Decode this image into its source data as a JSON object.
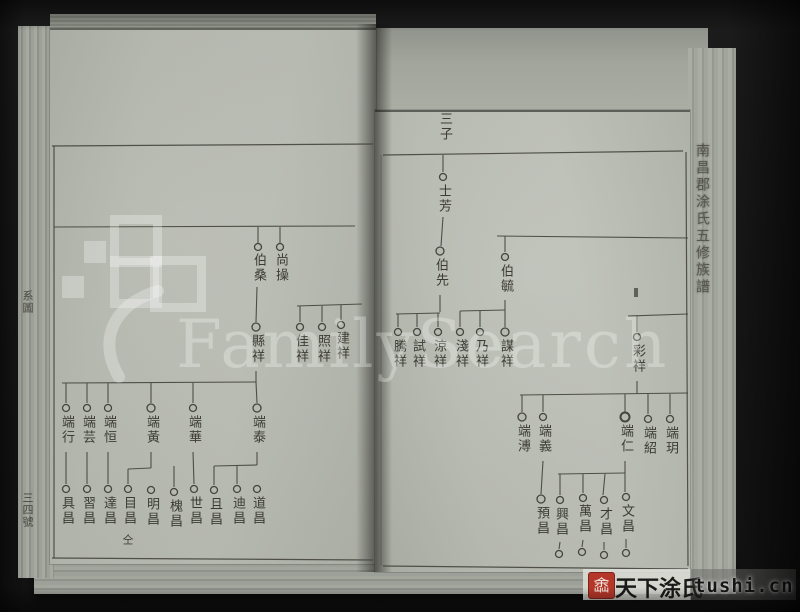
{
  "colors": {
    "background": "#161616",
    "page": "#b7bab1",
    "ink": "#45453e",
    "seal_red": "#b5372a",
    "watermark_white": "rgba(255,255,255,0.28)"
  },
  "watermark": {
    "brand": "FamilySearch",
    "site_name": "天下涂氏",
    "site_url": "tushi.cn",
    "seal_char": "嵞"
  },
  "book": {
    "edge_title": "南昌郡涂氏五修族譜",
    "margin_label": "系圖",
    "page_number": "三四號"
  },
  "left_page": {
    "gen1": [
      "伯桑",
      "尚操"
    ],
    "gen2": [
      "縣祥",
      "佳祥",
      "照祥",
      "建祥"
    ],
    "gen3": [
      "端行",
      "端芸",
      "端恒",
      "端黃",
      "端華",
      "端泰"
    ],
    "gen4": [
      "具昌",
      "習昌",
      "達昌",
      "目昌",
      "明昌",
      "槐昌",
      "世昌",
      "且昌",
      "迪昌",
      "道昌"
    ],
    "note": "仝"
  },
  "right_page": {
    "header": "三子",
    "gen0": "士芳",
    "gen1": [
      "伯先",
      "伯毓"
    ],
    "gen2": [
      "騰祥",
      "試祥",
      "涼祥",
      "淺祥",
      "乃祥",
      "謀祥",
      "彩祥"
    ],
    "gen3": [
      "端溥",
      "端義",
      "端仁",
      "端紹",
      "端玥"
    ],
    "gen4": [
      "預昌",
      "興昌",
      "萬昌",
      "才昌",
      "文昌"
    ]
  }
}
